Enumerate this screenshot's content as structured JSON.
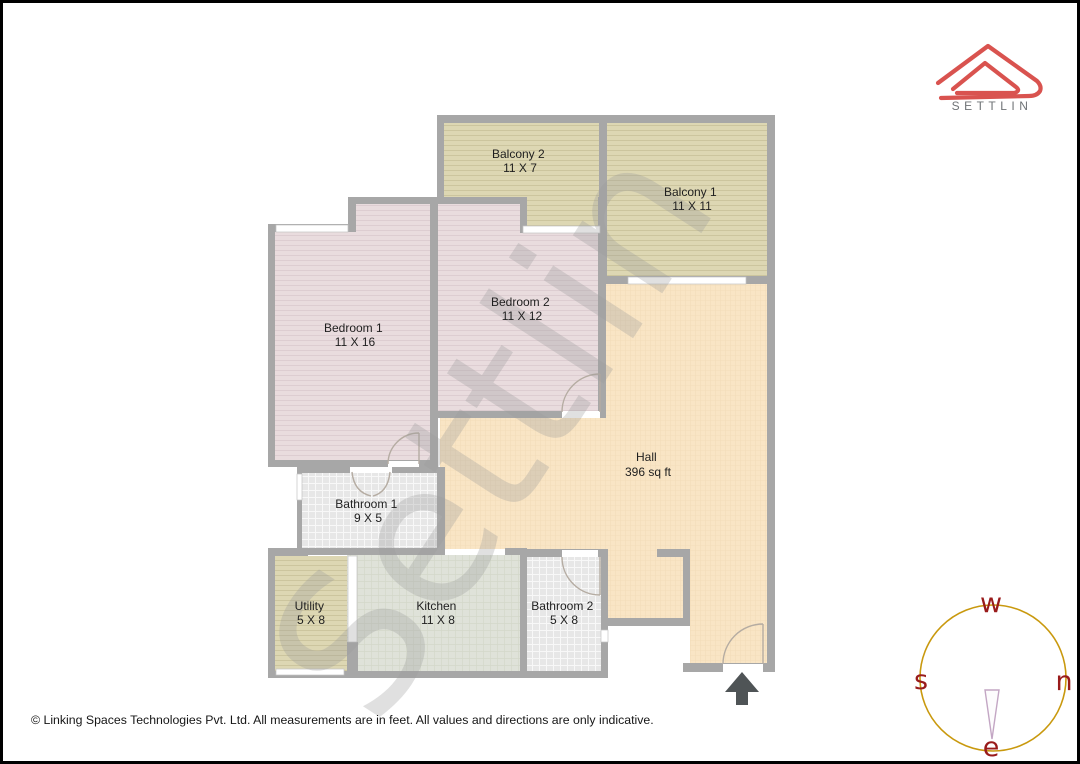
{
  "page": {
    "background": "#ffffff",
    "border_color": "#000000"
  },
  "logo": {
    "brand": "SETTLIN",
    "accent": "#d9534f",
    "text_color": "#6f7376"
  },
  "watermark": {
    "text": "Settlin",
    "color": "#9a9a9a"
  },
  "plan": {
    "wall_color": "#a7a7a7",
    "entrance_arrow_color": "#4f5456",
    "rooms": [
      {
        "id": "bedroom1",
        "name": "Bedroom 1",
        "dims": "11 X 16",
        "floor": "#e9dcde"
      },
      {
        "id": "bedroom2",
        "name": "Bedroom 2",
        "dims": "11 X 12",
        "floor": "#e9dcde"
      },
      {
        "id": "balcony1",
        "name": "Balcony 1",
        "dims": "11 X 11",
        "floor": "#ddd7b3"
      },
      {
        "id": "balcony2",
        "name": "Balcony 2",
        "dims": "11 X 7",
        "floor": "#ddd7b3"
      },
      {
        "id": "hall",
        "name": "Hall",
        "dims": "396 sq ft",
        "floor": "#f9e5c5"
      },
      {
        "id": "bathroom1",
        "name": "Bathroom 1",
        "dims": "9 X 5",
        "floor": "#e7e7e7"
      },
      {
        "id": "bathroom2",
        "name": "Bathroom 2",
        "dims": "5 X 8",
        "floor": "#e7e7e7"
      },
      {
        "id": "kitchen",
        "name": "Kitchen",
        "dims": "11 X 8",
        "floor": "#dfe2d9"
      },
      {
        "id": "utility",
        "name": "Utility",
        "dims": "5 X 8",
        "floor": "#ddd7b3"
      }
    ]
  },
  "compass": {
    "top": "w",
    "left": "s",
    "right": "n",
    "bottom": "e",
    "circle_color": "#c9990e",
    "letter_color": "#991b1b",
    "needle_color": "#c3a6c4"
  },
  "footer": {
    "copyright": "© Linking Spaces Technologies Pvt. Ltd. All measurements are in feet. All values and directions are only indicative."
  }
}
